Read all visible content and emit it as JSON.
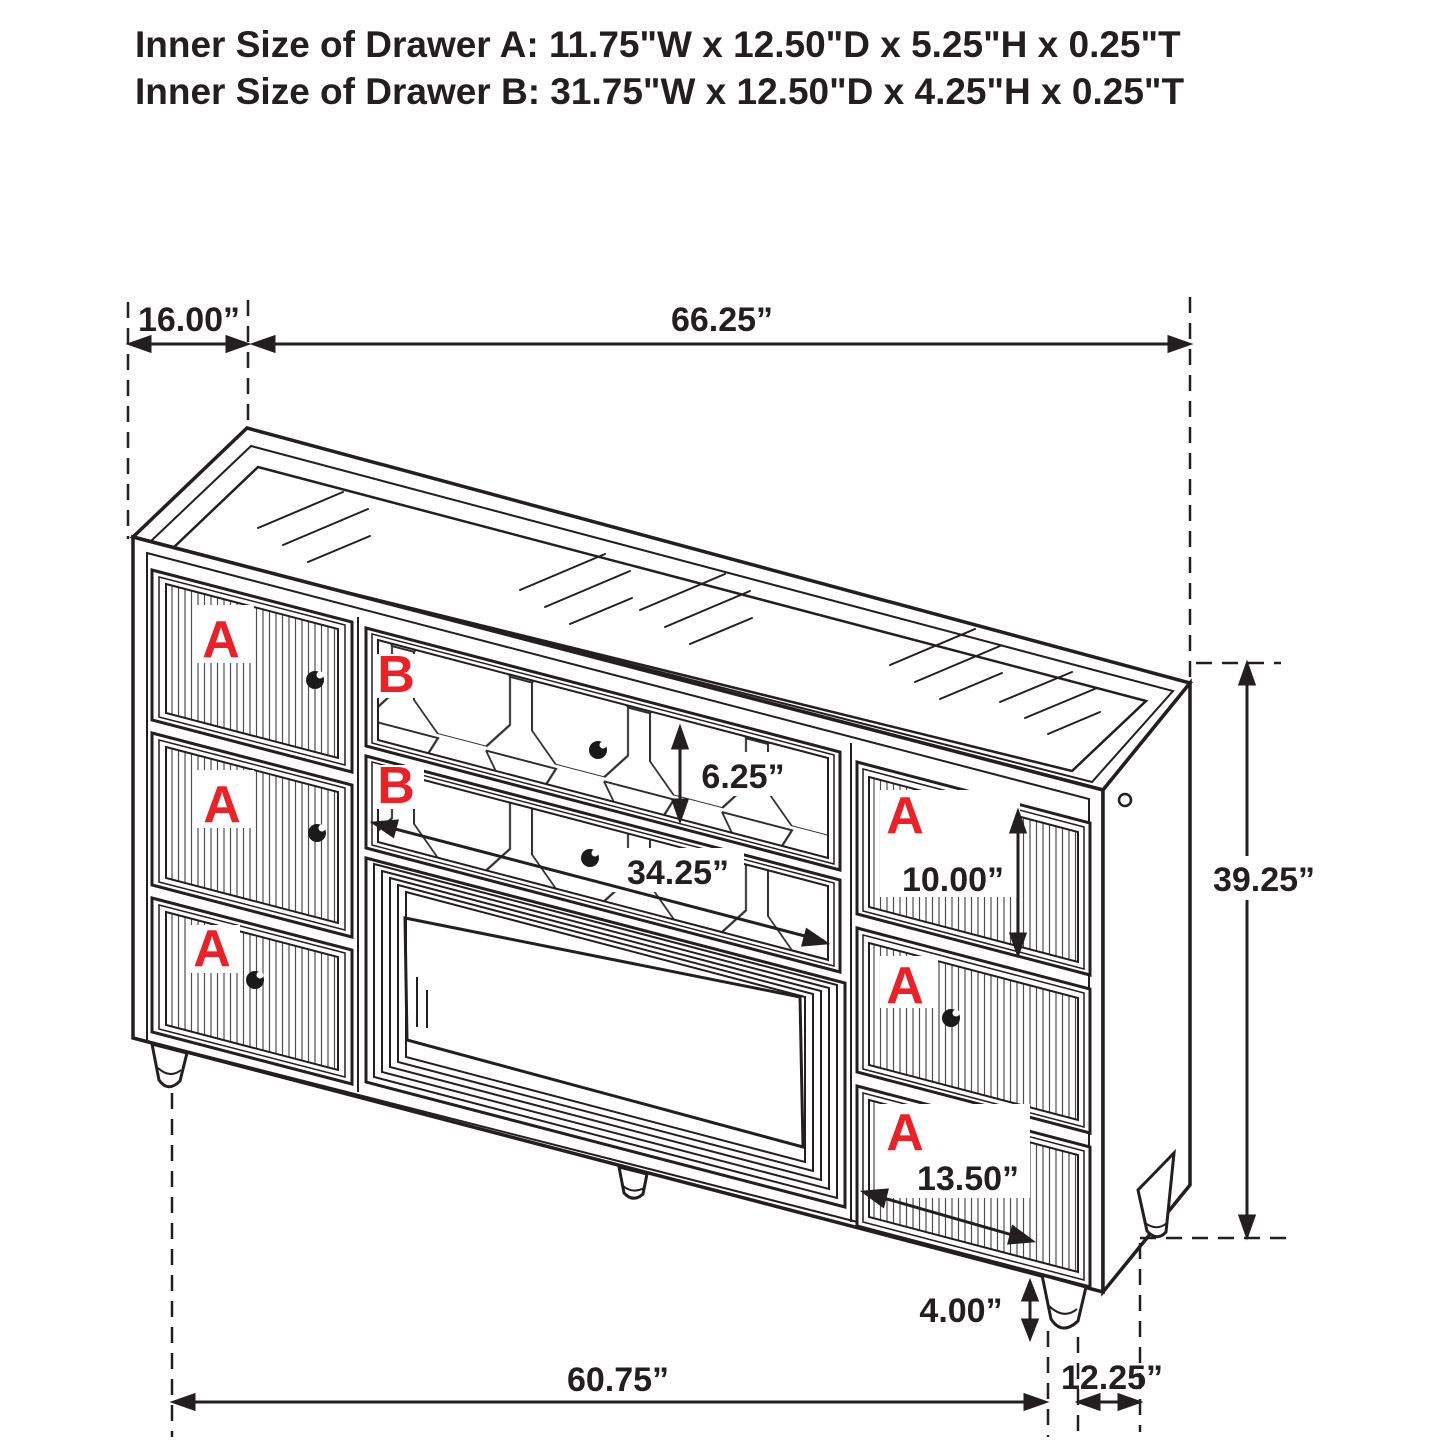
{
  "title": {
    "line1": "Inner Size of Drawer A: 11.75\"W x 12.50\"D x 5.25\"H x 0.25\"T",
    "line2": "Inner Size of Drawer B: 31.75\"W x 12.50\"D x 4.25\"H x 0.25\"T"
  },
  "drawer_labels": {
    "a": "A",
    "b": "B"
  },
  "dimensions": {
    "top_depth": "16.00”",
    "top_width": "66.25”",
    "b_drawer_front_height": "6.25”",
    "b_drawer_front_width": "34.25”",
    "a_drawer_right_height": "10.00”",
    "overall_height": "39.25”",
    "a_drawer_right_width": "13.50”",
    "leg_height": "4.00”",
    "base_width": "60.75”",
    "base_depth": "12.25”"
  },
  "colors": {
    "line": "#231f20",
    "label_red": "#ec2027",
    "background": "#ffffff"
  }
}
